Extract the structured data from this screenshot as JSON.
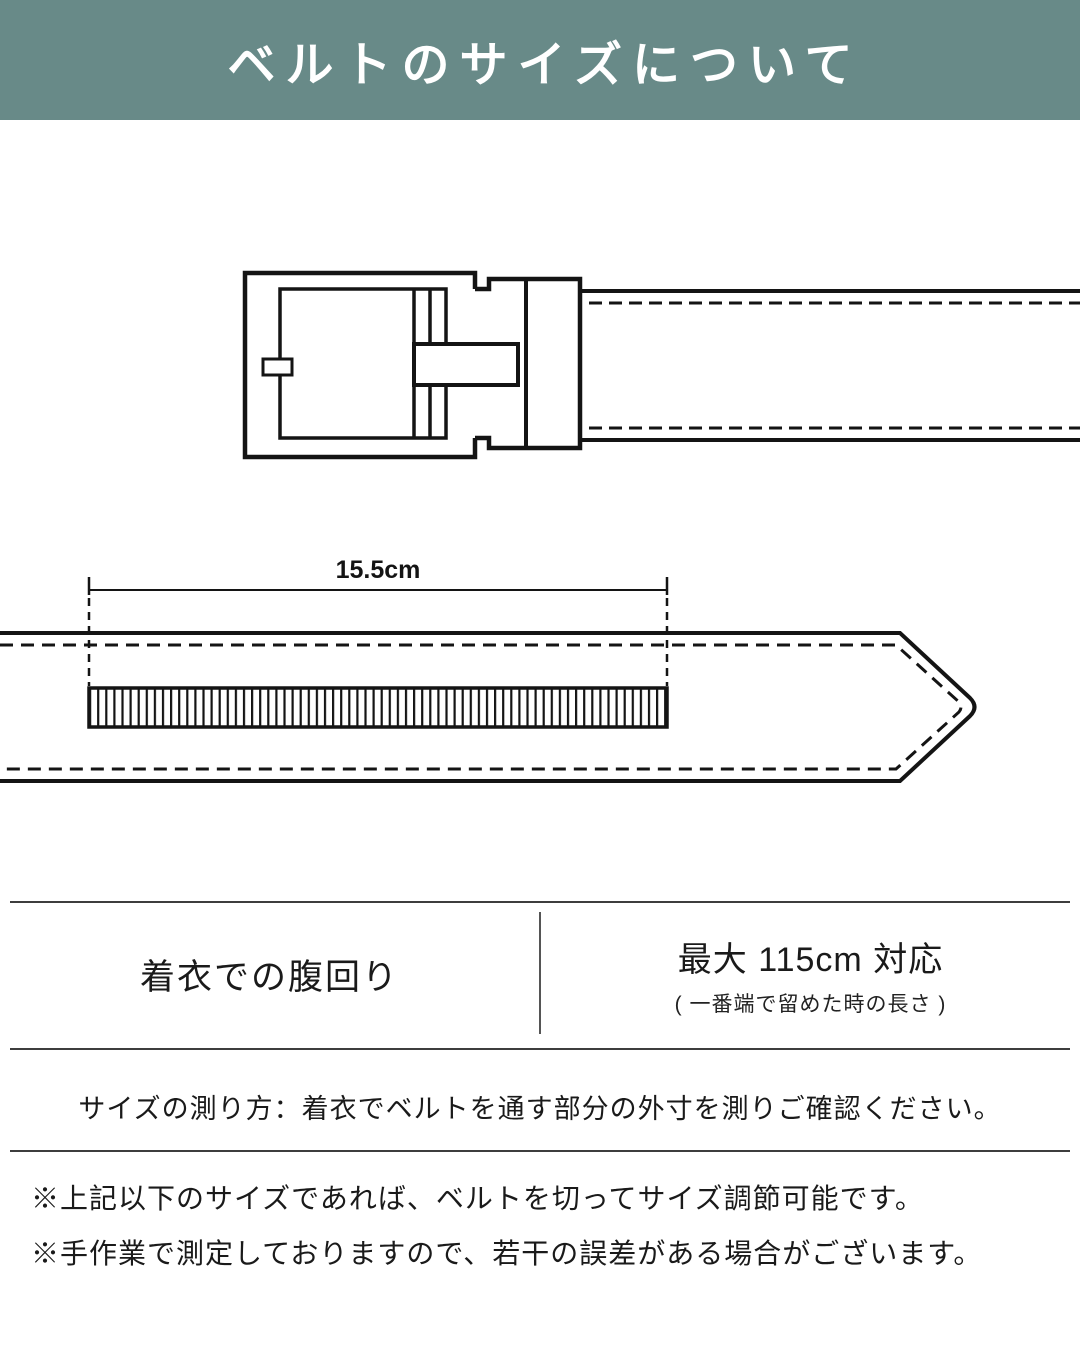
{
  "header": {
    "title": "ベルトのサイズについて",
    "bg_color": "#688a88",
    "text_color": "#ffffff"
  },
  "diagram": {
    "length_label": "15.5cm",
    "line_color": "#111111"
  },
  "size_table": {
    "row_label": "着衣での腹回り",
    "value_main": "最大 115cm 対応",
    "value_note": "( 一番端で留めた時の長さ )"
  },
  "measure_instruction": "サイズの測り方：着衣でベルトを通す部分の外寸を測りご確認ください。",
  "notes": [
    "※上記以下のサイズであれば、ベルトを切ってサイズ調節可能です。",
    "※手作業で測定しておりますので、若干の誤差がある場合がございます。"
  ]
}
